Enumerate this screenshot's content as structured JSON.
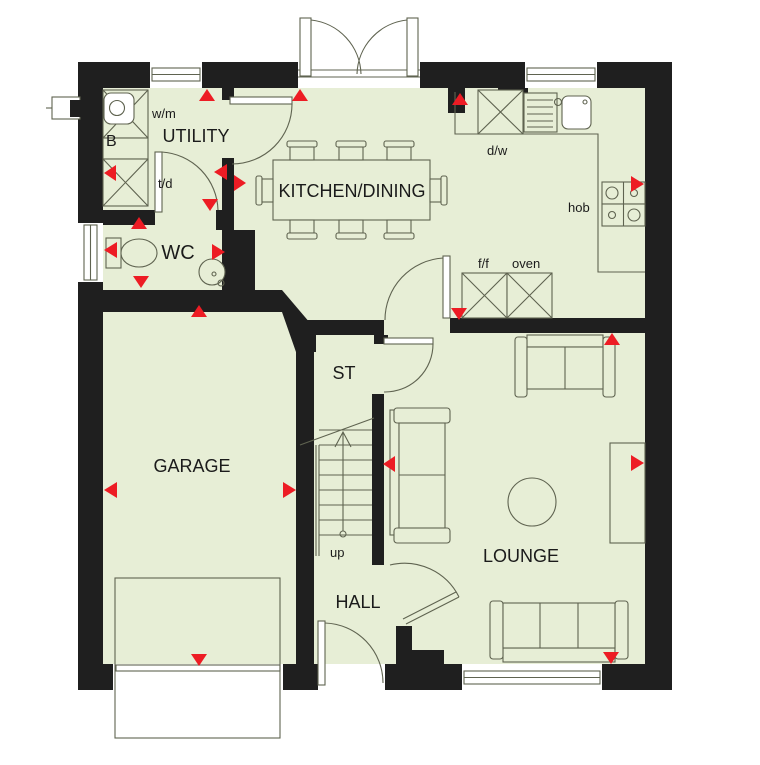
{
  "plan": {
    "title": "ground-floor-plan",
    "rooms": {
      "utility": "UTILITY",
      "wc": "WC",
      "kitchen_dining": "KITCHEN/DINING",
      "garage": "GARAGE",
      "store": "ST",
      "hall": "HALL",
      "lounge": "LOUNGE"
    },
    "appliances": {
      "washing_machine": "w/m",
      "tumble_dryer": "t/d",
      "boiler": "B",
      "dishwasher": "d/w",
      "hob": "hob",
      "fridge_freezer": "f/f",
      "oven": "oven"
    },
    "stairs": {
      "direction_label": "up"
    },
    "colors": {
      "floor": "#e7eed6",
      "wall": "#1f1f1f",
      "marker": "#ed1c24",
      "outline": "#5f6350"
    }
  }
}
